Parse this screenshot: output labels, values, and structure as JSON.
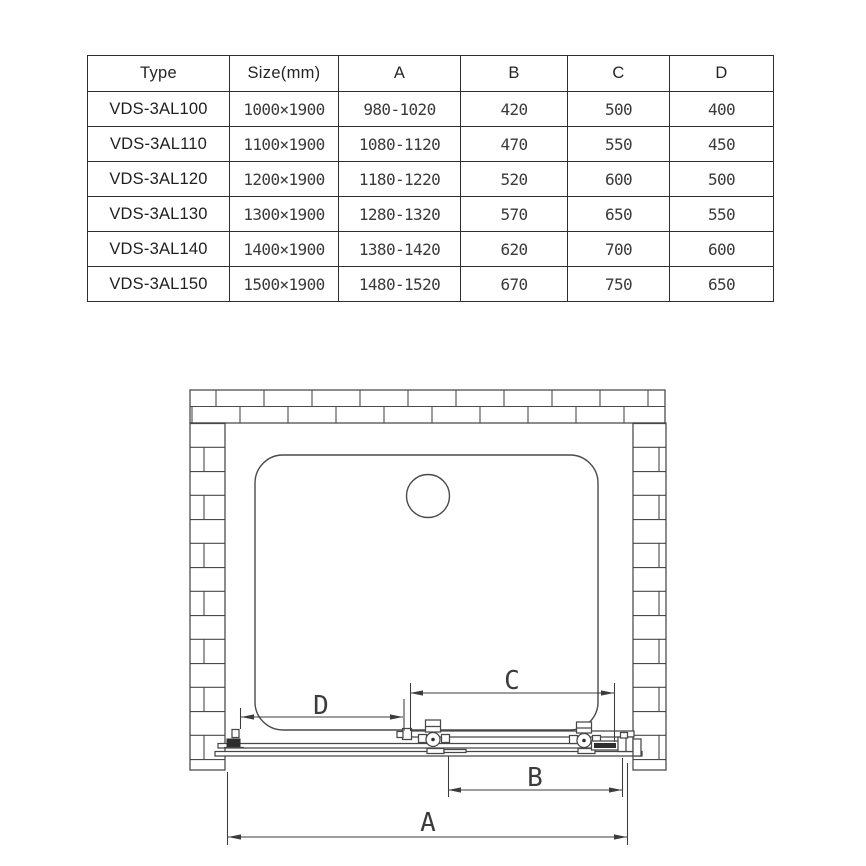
{
  "table": {
    "headers": [
      "Type",
      "Size(mm)",
      "A",
      "B",
      "C",
      "D"
    ],
    "rows": [
      [
        "VDS-3AL100",
        "1000×1900",
        "980-1020",
        "420",
        "500",
        "400"
      ],
      [
        "VDS-3AL110",
        "1100×1900",
        "1080-1120",
        "470",
        "550",
        "450"
      ],
      [
        "VDS-3AL120",
        "1200×1900",
        "1180-1220",
        "520",
        "600",
        "500"
      ],
      [
        "VDS-3AL130",
        "1300×1900",
        "1280-1320",
        "570",
        "650",
        "550"
      ],
      [
        "VDS-3AL140",
        "1400×1900",
        "1380-1420",
        "620",
        "700",
        "600"
      ],
      [
        "VDS-3AL150",
        "1500×1900",
        "1480-1520",
        "670",
        "750",
        "650"
      ]
    ]
  },
  "diagram": {
    "labels": {
      "a": "A",
      "b": "B",
      "c": "C",
      "d": "D"
    }
  },
  "colors": {
    "line": "#474747",
    "background": "#ffffff"
  }
}
